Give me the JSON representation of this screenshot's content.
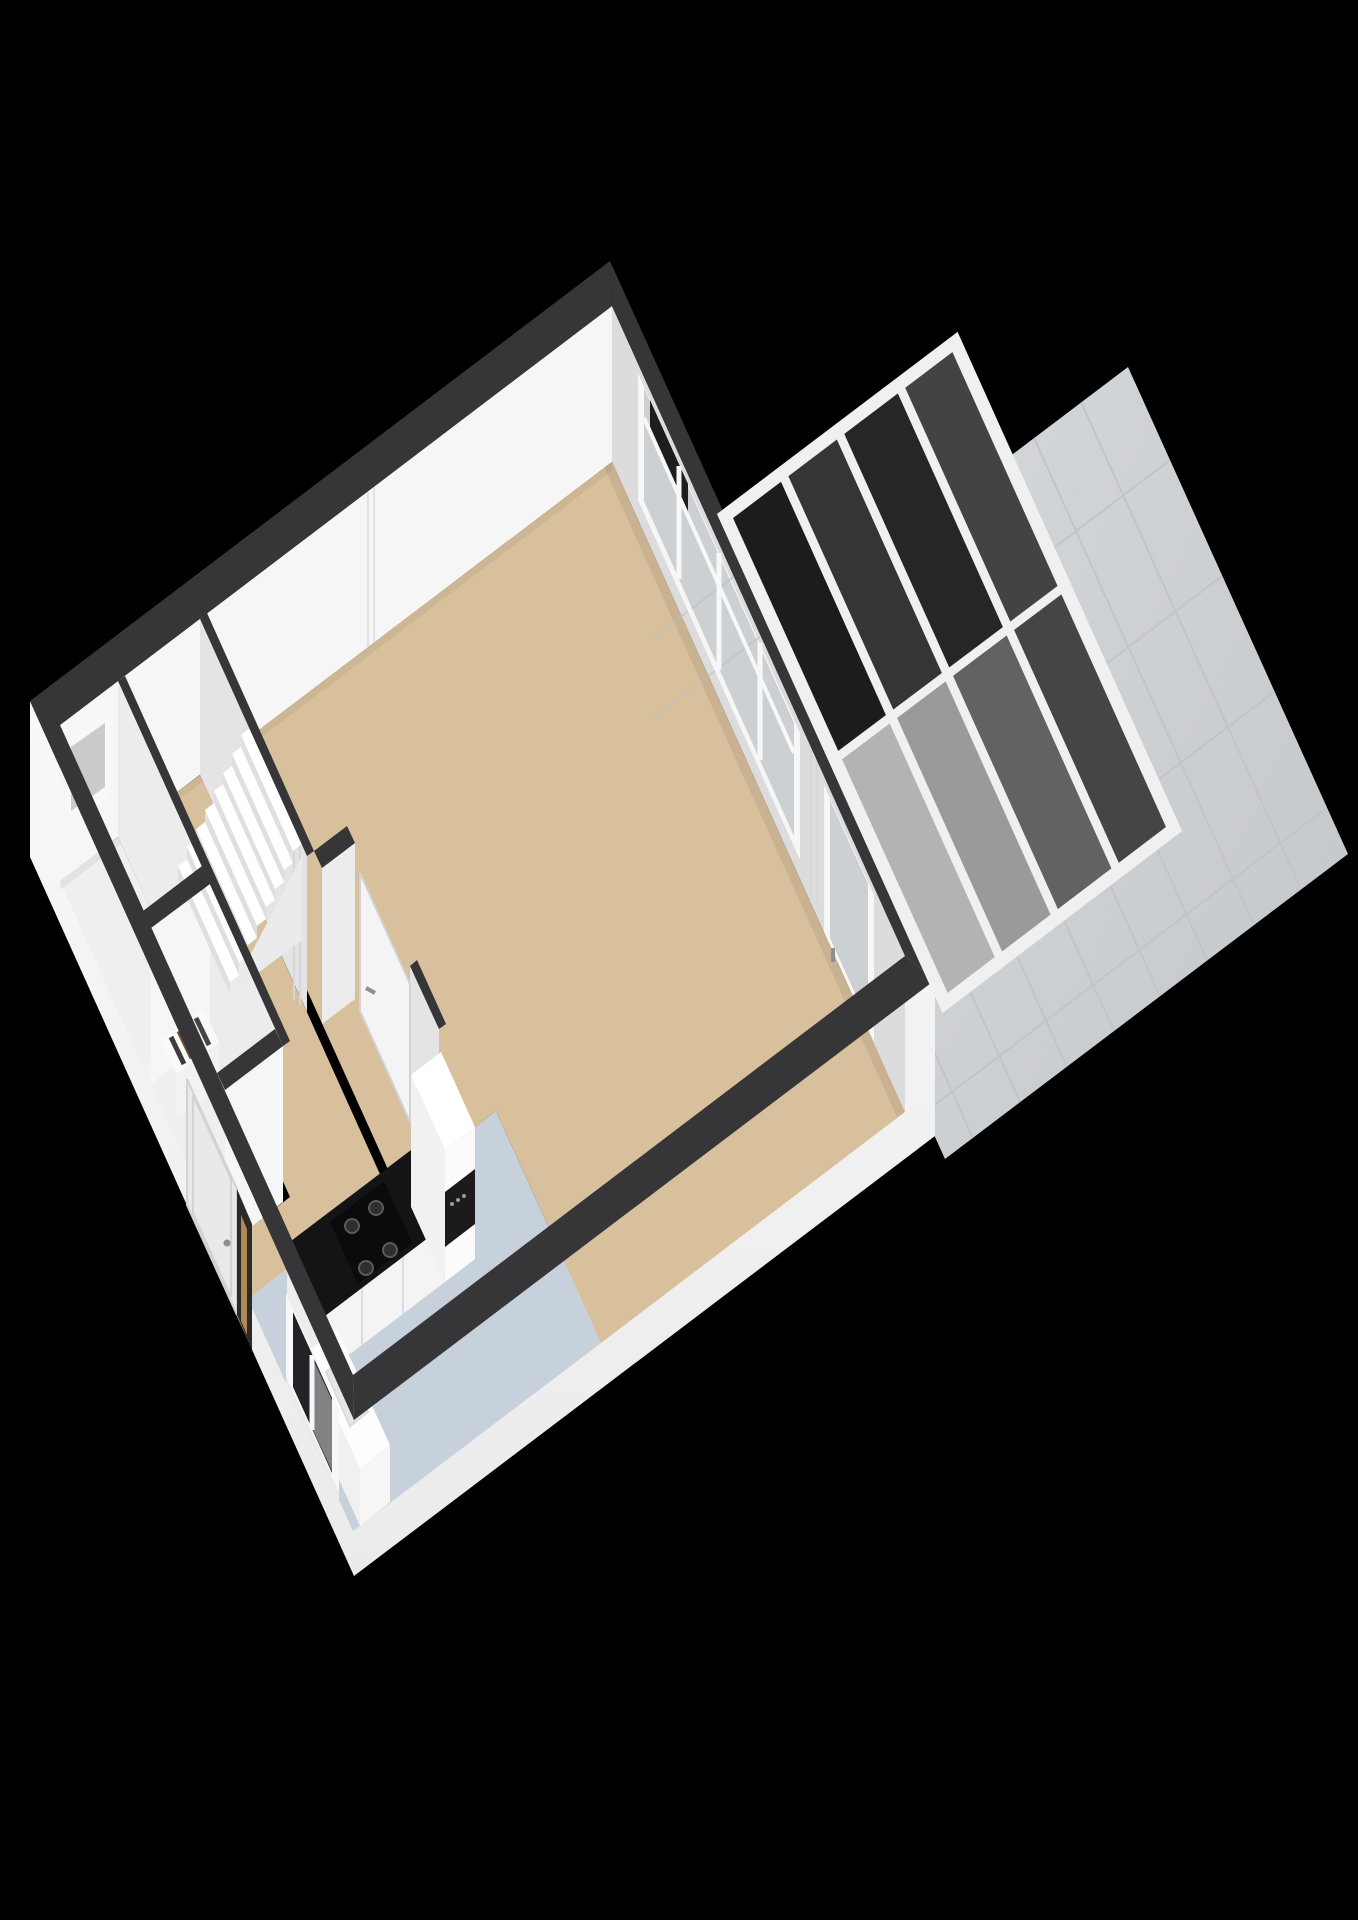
{
  "scene": {
    "type": "3d-floorplan-render",
    "view": "isometric-birdseye",
    "background": "#000000"
  },
  "colors": {
    "background": "#000000",
    "wall_top": "#363638",
    "ext_face_light": "#f8f8f8",
    "ext_face": "#f3f3f3",
    "ext_face_shade": "#ebebec",
    "int_face_light": "#f6f6f6",
    "int_face_shadow": "#dcdcdd",
    "partition_face": "#ececec",
    "partition_face_dim": "#e4e4e5",
    "floor_wood": "#d8c09c",
    "floor_kitchen": "#c7d1dc",
    "floor_room": "#efefef",
    "stair_tread": "#ffffff",
    "stair_riser": "#dfdfe1",
    "stair_skirt": "#ebebed",
    "frame_white": "#f7f7f7",
    "glass_garden": "#ccd0d3",
    "glass_line": "#bdc1c4",
    "glass_dark": "#232327",
    "glass_vent": "#1d1d20",
    "glass_sidelight": "#2c2a26",
    "wood_sliver": "#c79a62",
    "door_leaf": "#f4f4f5",
    "door_front": "#e9e9ea",
    "door_edge": "#d2d2d4",
    "handle": "#8f8f91",
    "counter_front": "#f4f4f4",
    "counter_end": "#ededee",
    "counter_seam": "#dcdcde",
    "counter_top": "#141417",
    "cooktop": "#0b0b0d",
    "burner": "#2f2f31",
    "burner_ring": "#5a5a5c",
    "oven": "#1b1b1e",
    "oven_light": "#9a9a9c",
    "cabinet_white": "#fbfbfc",
    "cabinet_side": "#f1f1f2",
    "cabinet_top": "#ffffff",
    "sink_top": "#fdfdfd",
    "sink_front": "#f0f0f1",
    "sink_side": "#f6f6f7",
    "sink_basin": "#e6e6e8",
    "faucet": "#9a9a9c",
    "radiator_top": "#fafafa",
    "radiator_front": "#f2f2f3",
    "niche_frame": "#f8f8f8",
    "niche_inner": "#cbcbcd",
    "seam": "#d6d6d8",
    "seam_light": "#e2e2e4",
    "patio_a": "#d9dcde",
    "patio_b": "#c7cacd",
    "patio_grid": "#c2c5c8",
    "beam": "#f0f0f1",
    "ao": "#000000"
  },
  "roof": {
    "rows": 2,
    "cols": 4,
    "panel_fills": [
      "#1c1c1e",
      "#353537",
      "#262628",
      "#434345",
      "#b3b3b5",
      "#9a9a9c",
      "#626264",
      "#454547"
    ]
  },
  "radiator": {
    "slat_colors": [
      "#3c3c3e",
      "#6e4b32",
      "#2e2e30",
      "#454547"
    ]
  },
  "rooms": [
    {
      "name": "living-room",
      "floor": "wood"
    },
    {
      "name": "kitchen",
      "floor": "tile-blue"
    },
    {
      "name": "hallway-with-stairs",
      "floor": "wood"
    },
    {
      "name": "front-storage-room",
      "floor": "light"
    },
    {
      "name": "back-storage-room",
      "floor": "light"
    },
    {
      "name": "covered-terrace",
      "floor": "dark-glass-roof"
    },
    {
      "name": "garden-patio",
      "floor": "light-tiles"
    }
  ],
  "fixtures": [
    "staircase-8-steps",
    "kitchen-counter-gas-hob",
    "tall-cabinet-with-oven",
    "sink-unit-by-window",
    "meter-rack",
    "front-door-with-sidelight",
    "interior-door",
    "garden-window-band",
    "garden-glass-door",
    "glass-roof-grid"
  ]
}
